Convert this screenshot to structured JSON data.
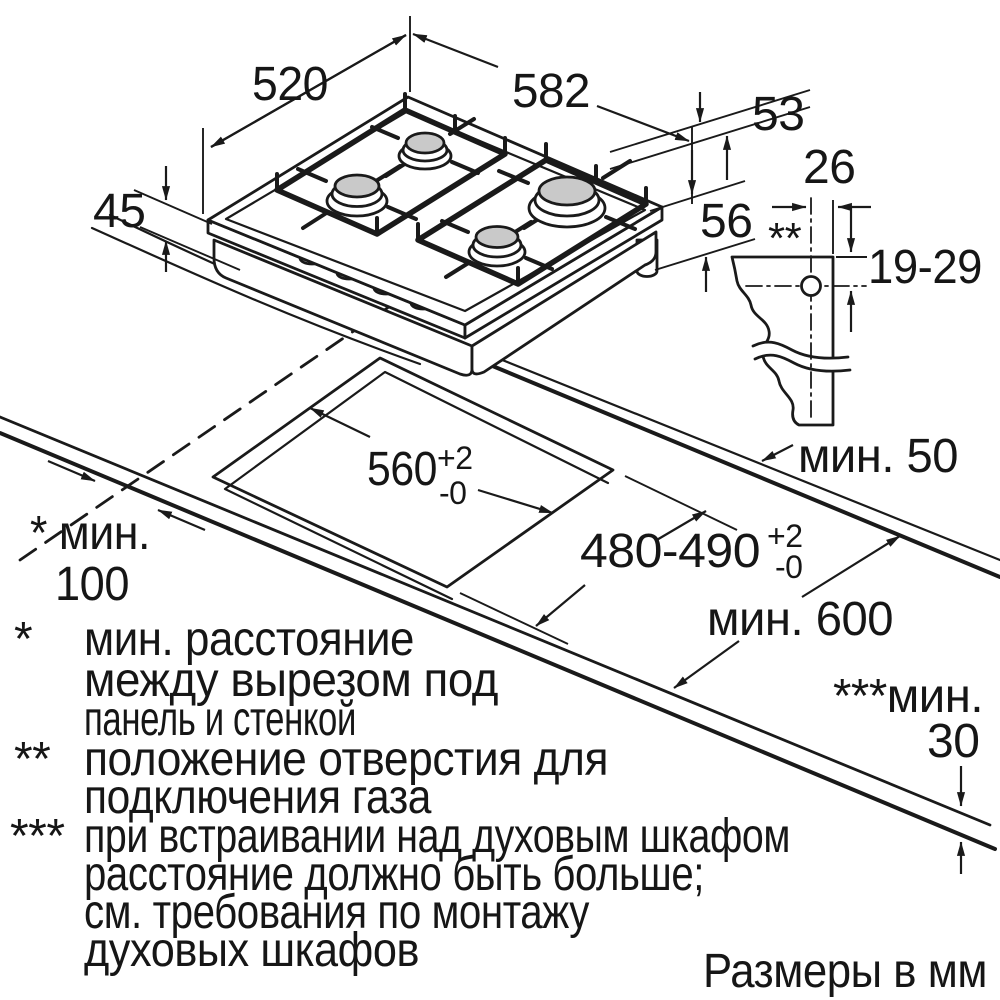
{
  "figure": {
    "caption": "Размеры в мм"
  },
  "dims": {
    "hob_depth": "520",
    "hob_width": "582",
    "hob_rim_height": "53",
    "hob_total_height": "45",
    "hob_body_drop": "56",
    "gas_hole_offset": "26",
    "gas_hole_marker": "**",
    "gas_hole_height_range": "19-29",
    "cutout_width": "560",
    "cutout_width_tol_plus": "+2",
    "cutout_width_tol_minus": "-0",
    "cutout_depth": "480-490",
    "cutout_depth_tol_plus": "+2",
    "cutout_depth_tol_minus": "-0",
    "min_rear_clearance": "мин. 50",
    "min_worktop_depth": "мин. 600",
    "min_side_clearance_label": "* мин.",
    "min_side_clearance_value": "100",
    "min_thickness_label": "***мин.",
    "min_thickness_value": "30"
  },
  "footnotes": {
    "star": {
      "bullet": "*",
      "lines": [
        "мин. расстояние",
        "между вырезом под",
        "панель и стенкой"
      ]
    },
    "double_star": {
      "bullet": "**",
      "lines": [
        "положение отверстия для",
        "подключения газа"
      ]
    },
    "triple_star": {
      "bullet": "***",
      "lines": [
        "при встраивании над духовым шкафом",
        "расстояние должно быть больше;",
        "см. требования по монтажу",
        "духовых шкафов"
      ]
    }
  }
}
